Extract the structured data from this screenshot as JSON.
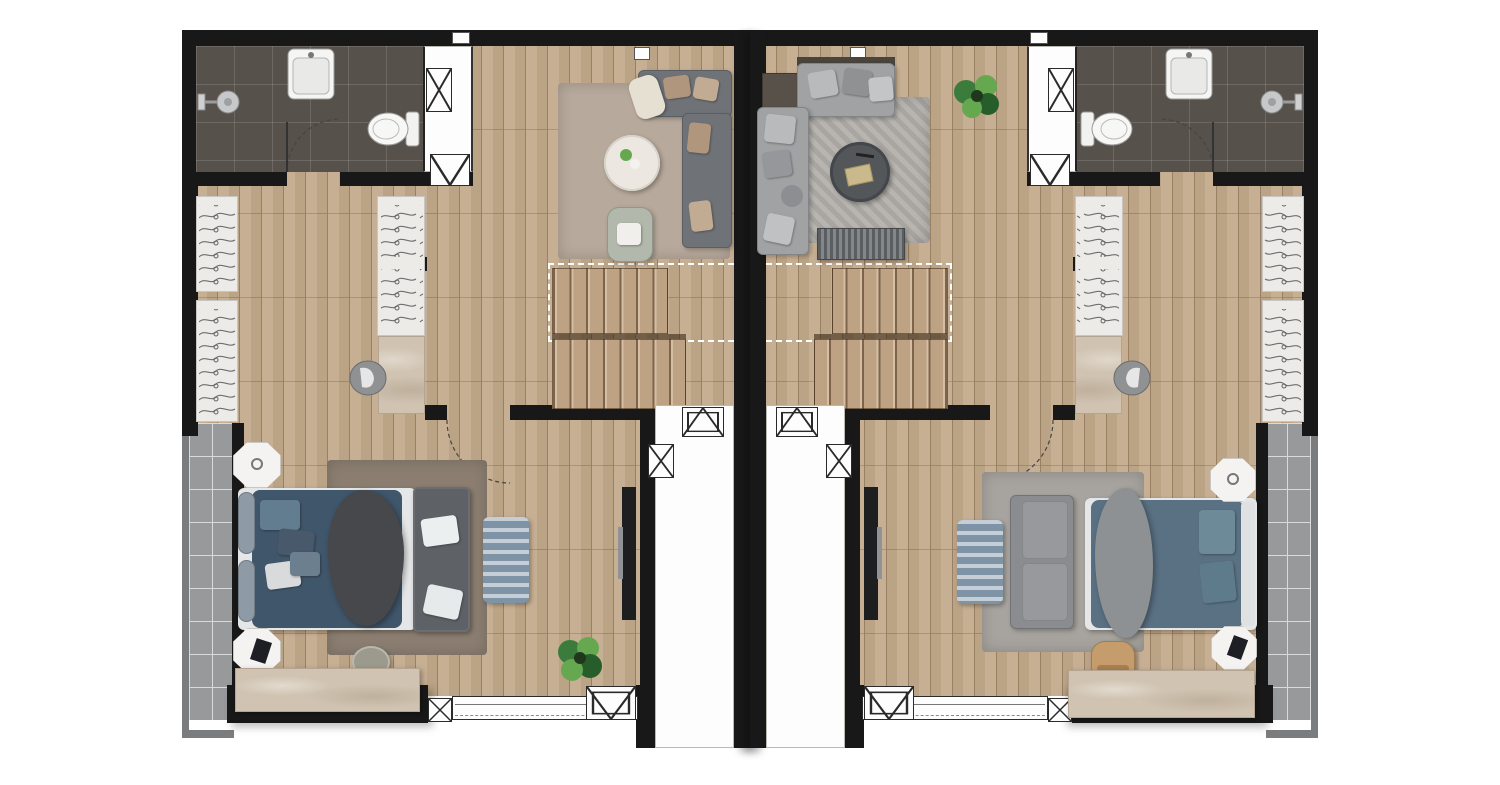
{
  "document": {
    "type": "architectural-floor-plan",
    "view": "top-down rendered plan",
    "description": "Two mirrored duplex townhouse units, upper floor: en-suite bathroom, wardrobe corridor, living area, twin-flight staircase, master bedroom, side balcony, central entry light-well"
  },
  "palette": {
    "page": "#ffffff",
    "wall": "#181818",
    "wood": "#c3aa8c",
    "wood-line": "#a08666",
    "wood-stair": "#bda283",
    "bath-tile": "#57514c",
    "balcony": "#97999b",
    "balcony-line": "#d9dadb",
    "parapet": "#7a7c7e",
    "void": "#fdfdfd",
    "stone": "#d0c3b1",
    "stone-line": "#b3a591",
    "credenza-vein": "#bfb19d",
    "wardrobe": "#edebe8",
    "hanger": "#6e6e6e",
    "rug-living-left": "#b7a99b",
    "rug-living-right": "#b2afaa",
    "rug-bed-left": "#8b7e71",
    "rug-bed-right": "#a7a39e",
    "sofa-dark": "#6f7377",
    "sofa-light": "#a0a2a4",
    "pillow-tan": "#b0967d",
    "bench": "#5e6266",
    "bed-navy": "#40566a",
    "bed-slate": "#5a7184",
    "pillow-blue": "#6d8a99",
    "sheet": "#e5e6e7",
    "fur-dark": "#46484c",
    "fur-light": "#8e9193",
    "ottoman-blue": "#7e93a6",
    "table-white": "#ece8e1",
    "table-dark": "#54575a",
    "armchair": "#b2b8ab",
    "pouf": "#e6e0d3",
    "chair-tan": "#c59d6d",
    "plant": "#3b7c3c",
    "plant-dark": "#275d2a",
    "plant-light": "#66a84f",
    "fixture": "#2a2a2a"
  },
  "units": [
    {
      "id": "unit-left",
      "rooms": {
        "bathroom": [
          "shower-head",
          "washbasin",
          "toilet",
          "door-swing"
        ],
        "wardrobe-corridor": [
          "wardrobe-hangers-left-upper",
          "wardrobe-hangers-left-lower",
          "wardrobe-hangers-middle",
          "stone-vanity-counter",
          "round-basin"
        ],
        "living-area": [
          "l-shaped-sofa-dark",
          "tan-pillows",
          "knit-pouf",
          "round-coffee-table-white",
          "armchair-sage",
          "area-rug-beige"
        ],
        "staircase": [
          "upper-flight",
          "lower-flight",
          "open-void-dashed-line"
        ],
        "bedroom": [
          "double-bed-navy",
          "fur-throw-dark",
          "headboard-cushions",
          "nightstand-top",
          "nightstand-bottom",
          "bench-at-foot",
          "blue-ottoman-rug",
          "round-stool",
          "stone-credenza",
          "potted-plant",
          "area-rug-taupe",
          "door-swing-dashed"
        ],
        "balcony": [
          "tiled-deck",
          "parapet"
        ],
        "entry-lightwell": [
          "glass-door-slab",
          "awning-window",
          "duct-shaft"
        ],
        "service-shaft": [
          "duct-x",
          "duct-v"
        ],
        "facade": [
          "window-band",
          "awning-window",
          "duct-x"
        ]
      }
    },
    {
      "id": "unit-right",
      "mirror_of": "unit-left",
      "rooms": {
        "bathroom": [
          "shower-head",
          "washbasin",
          "toilet",
          "door-swing"
        ],
        "wardrobe-corridor": [
          "wardrobe-hangers-right-upper",
          "wardrobe-hangers-right-lower",
          "wardrobe-hangers-middle",
          "stone-vanity-counter",
          "round-basin"
        ],
        "living-area": [
          "sectional-sofa-light",
          "side-console-dark",
          "round-coffee-table-marble",
          "tray-with-books",
          "media-bench-ribbed",
          "area-rug-gray",
          "potted-plant"
        ],
        "staircase": [
          "upper-flight",
          "lower-flight",
          "open-void-dashed-line"
        ],
        "bedroom": [
          "double-bed-slate",
          "fur-throw-gray",
          "pillows-teal",
          "nightstand-top",
          "nightstand-bottom",
          "two-seat-sofa",
          "blue-ottoman-rug",
          "writing-desk-stone",
          "desk-chair-tan",
          "area-rug-gray",
          "door-swing-dashed"
        ],
        "balcony": [
          "tiled-deck",
          "parapet"
        ],
        "entry-lightwell": [
          "glass-door-slab",
          "awning-window",
          "duct-shaft"
        ]
      }
    }
  ]
}
